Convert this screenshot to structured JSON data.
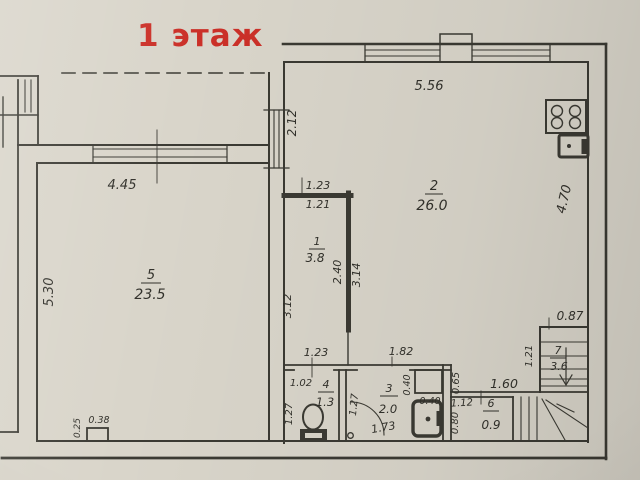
{
  "title": "1 этаж",
  "colors": {
    "title_red": "#cb3028",
    "paper": "#d9d5ca",
    "line": "#3b3a33",
    "ink": "#32312b"
  },
  "rooms": {
    "r1": {
      "number": "1",
      "area": "3.8"
    },
    "r2": {
      "number": "2",
      "area": "26.0"
    },
    "r3": {
      "number": "3",
      "area": "2.0"
    },
    "r4": {
      "number": "4",
      "area": "1.3"
    },
    "r5": {
      "number": "5",
      "area": "23.5"
    },
    "r6": {
      "number": "6",
      "area": "0.9"
    },
    "r7": {
      "number": "7",
      "area": "3.6"
    }
  },
  "dims": {
    "room2_top": "5.56",
    "room2_left": "2.12",
    "room2_right": "4.70",
    "room5_top": "4.45",
    "room5_left": "5.30",
    "room1_top_outer": "1.23",
    "room1_top_inner": "1.21",
    "room1_inner_height": "2.40",
    "room1_outer_height": "3.14",
    "room1_left": "3.12",
    "passage_below_room1": "1.23",
    "passage_opening": "1.82",
    "room4_width": "1.02",
    "room4_height": "1.27",
    "room3_height": "1.27",
    "room3_width": "1.73",
    "washer_size": "0.40",
    "heater_size": "0.40",
    "niche_depth": "0.65",
    "niche_width": "1.60",
    "room6_width": "1.12",
    "room6_height": "0.80",
    "stair_width": "0.87",
    "stair_height": "1.21",
    "pilaster_height": "0.25",
    "pilaster_width": "0.38"
  },
  "icons": {
    "stove": "stove-icon",
    "sink": "sink-icon",
    "toilet": "toilet-icon",
    "washing_machine": "washing-machine-icon",
    "water_heater": "water-heater-icon",
    "stairs": "staircase",
    "down_arrow": "stairs-down-arrow"
  }
}
